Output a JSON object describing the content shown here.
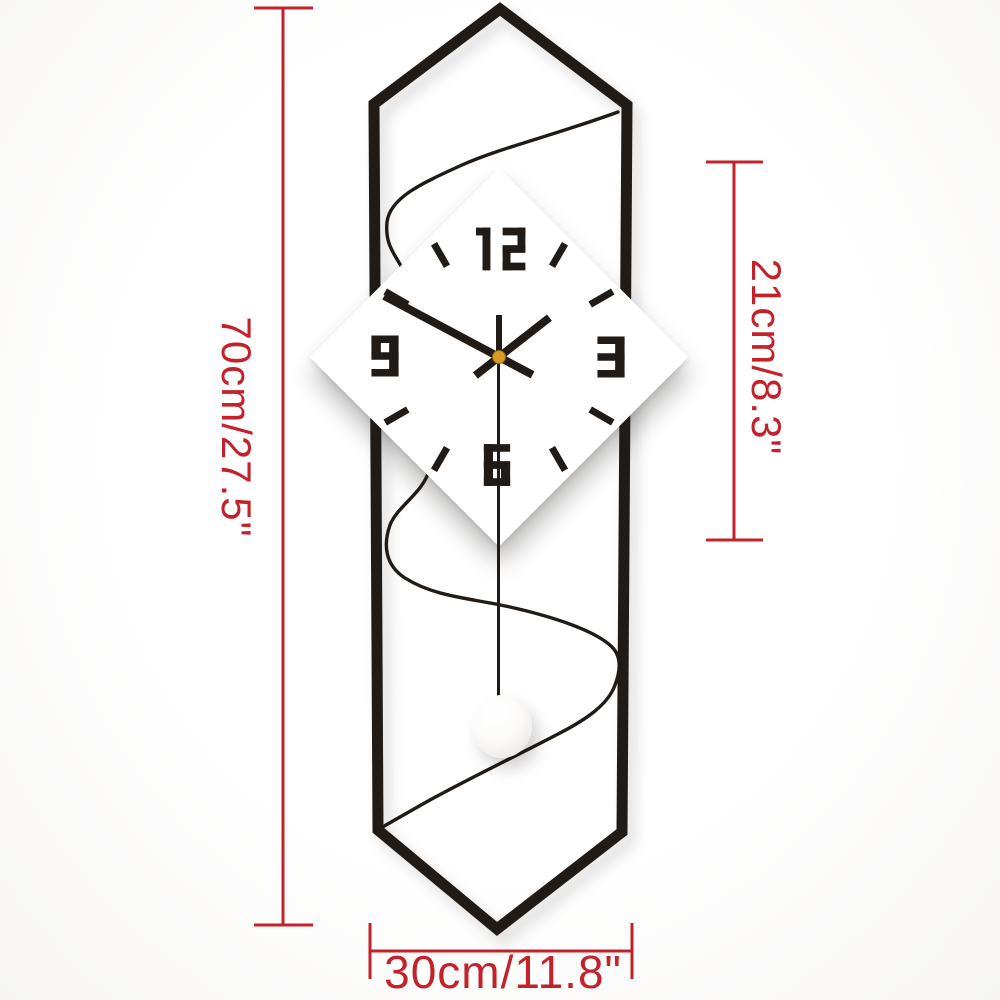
{
  "colors": {
    "ink": "#201b17",
    "dimension_red": "#c3222a",
    "center_cap": "#d99c22"
  },
  "clock": {
    "numerals": {
      "top": "12",
      "right": "3",
      "bottom": "6",
      "left": "9"
    },
    "tick_angles_deg": [
      30,
      60,
      120,
      150,
      210,
      240,
      300,
      330
    ],
    "hands": {
      "minute_deg": -62,
      "minute_tail_deg": 118,
      "hour_deg": 52,
      "hour_tail_deg": 232,
      "second_tail_deg": 0
    }
  },
  "dimensions": {
    "overall_height_label": "70cm/27.5\"",
    "clock_face_height_label": "21cm/8.3\"",
    "overall_width_label": "30cm/11.8\""
  }
}
